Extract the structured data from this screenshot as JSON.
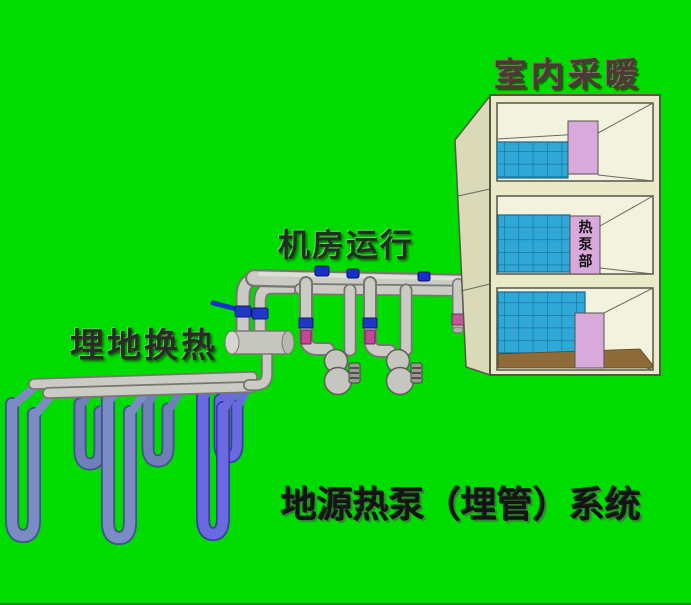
{
  "scene": {
    "background_color": "#00DC00",
    "labels": {
      "indoor_heating": "室内采暖",
      "machine_room": "机房运行",
      "ground_heat_exchange": "埋地换热",
      "system_title": "地源热泵（埋管）系统",
      "heat_pump_room": "热泵部"
    },
    "colors": {
      "building_front": "#EAEAC8",
      "building_side": "#DADAB8",
      "building_interior": "#F2F2DF",
      "outline_dark": "#55554A",
      "window_tile_blue": "#2FA8D8",
      "tile_grid_line": "#166B90",
      "panel_pink": "#D9A9DC",
      "floor_brown": "#8E6B38",
      "pipe_gray": "#CBCBC5",
      "pipe_shadow": "#77776F",
      "loop_pipe_blue": "#7B8CC4",
      "loop_pipe_purple": "#6A6AE0",
      "valve_blue": "#2038C8",
      "valve_magenta": "#C04898"
    }
  }
}
